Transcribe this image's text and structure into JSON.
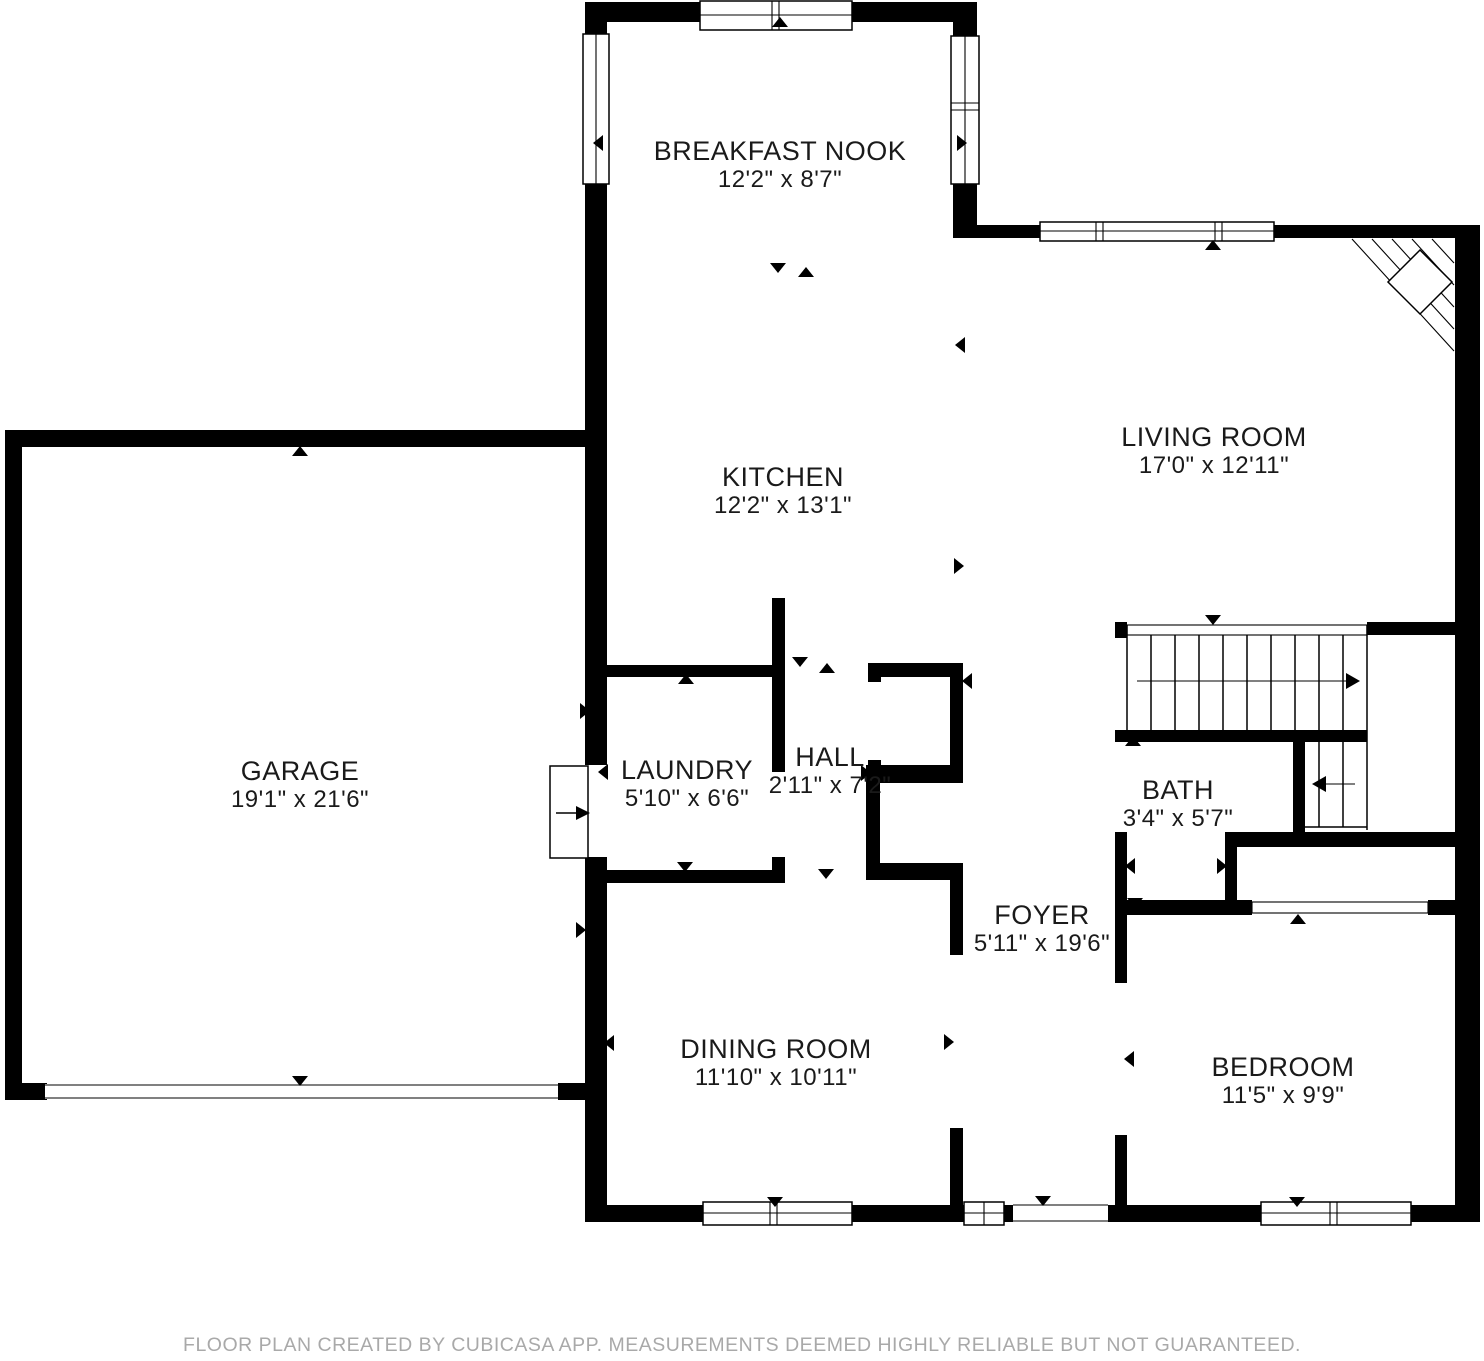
{
  "rooms": [
    {
      "id": "breakfast-nook",
      "name": "BREAKFAST NOOK",
      "dimensions": "12'2\" x 8'7\""
    },
    {
      "id": "living-room",
      "name": "LIVING ROOM",
      "dimensions": "17'0\" x 12'11\""
    },
    {
      "id": "kitchen",
      "name": "KITCHEN",
      "dimensions": "12'2\" x 13'1\""
    },
    {
      "id": "garage",
      "name": "GARAGE",
      "dimensions": "19'1\" x 21'6\""
    },
    {
      "id": "laundry",
      "name": "LAUNDRY",
      "dimensions": "5'10\" x 6'6\""
    },
    {
      "id": "hall",
      "name": "HALL",
      "dimensions": "2'11\" x 7'2\""
    },
    {
      "id": "bath",
      "name": "BATH",
      "dimensions": "3'4\" x 5'7\""
    },
    {
      "id": "foyer",
      "name": "FOYER",
      "dimensions": "5'11\" x 19'6\""
    },
    {
      "id": "dining-room",
      "name": "DINING ROOM",
      "dimensions": "11'10\" x 10'11\""
    },
    {
      "id": "bedroom",
      "name": "BEDROOM",
      "dimensions": "11'5\" x 9'9\""
    }
  ],
  "footer": {
    "text": "FLOOR PLAN CREATED BY CUBICASA APP. MEASUREMENTS DEEMED HIGHLY RELIABLE BUT NOT GUARANTEED."
  },
  "colors": {
    "wall": "#000000",
    "background": "#ffffff",
    "label_text": "#1a1a1a",
    "footer_text": "#a9a9a9"
  }
}
